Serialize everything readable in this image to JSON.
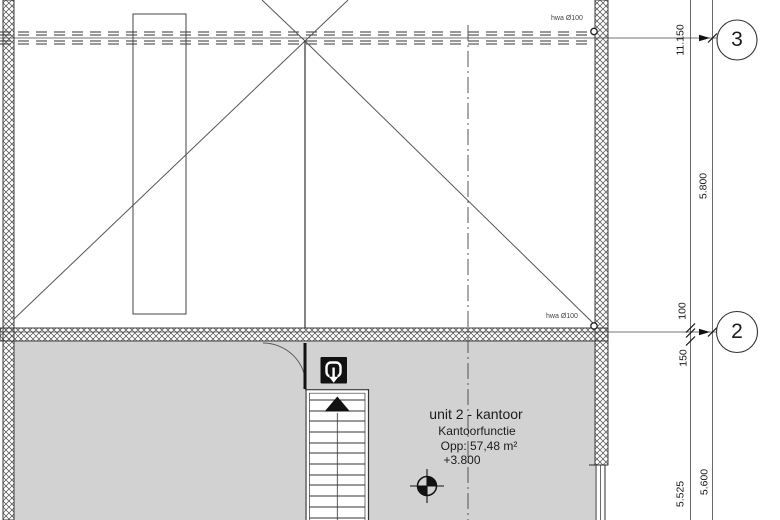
{
  "drawing": {
    "type": "architectural-floor-plan",
    "colors": {
      "line": "#3c3c3c",
      "wall_outline": "#2a2a2a",
      "room_fill": "#d2d2d2",
      "symbol_black": "#111111",
      "background": "#ffffff"
    },
    "grid": {
      "bubbles": [
        {
          "label": "3"
        },
        {
          "label": "2"
        }
      ]
    },
    "dimensions": {
      "inner_line": [
        "11.150",
        "100",
        "150",
        "5.525"
      ],
      "outer_line": [
        "5.800",
        "5.600"
      ]
    },
    "annotations": {
      "hwa_top": "hwa Ø100",
      "hwa_bottom": "hwa Ø100"
    },
    "room_label": {
      "name": "unit 2 - kantoor",
      "function": "Kantoorfunctie",
      "area": "Opp: 57,48 m²",
      "level": "+3.800"
    },
    "icons": {
      "stair_exit": "u-turn-down-arrow",
      "level_marker": "benchmark-crosshair",
      "rain_drain": "hwa-circle"
    }
  }
}
